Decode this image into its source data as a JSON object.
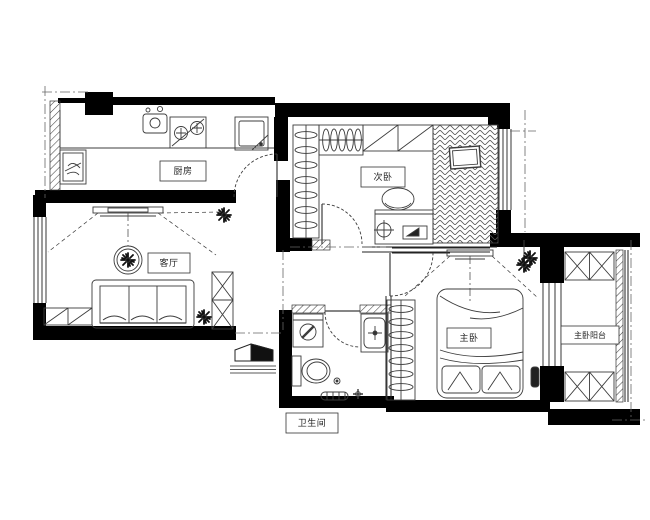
{
  "drawing": {
    "type": "apartment-floor-plan",
    "style": "black-and-white CAD line drawing",
    "colors": {
      "wall": "#000000",
      "line": "#3c3c3c",
      "background": "#ffffff"
    },
    "rooms": {
      "kitchen": {
        "label": "厨房"
      },
      "secondary_bedroom": {
        "label": "次卧"
      },
      "living_room": {
        "label": "客厅"
      },
      "master_bedroom": {
        "label": "主卧"
      },
      "master_balcony": {
        "label": "主卧阳台"
      },
      "bathroom": {
        "label": "卫生间"
      }
    },
    "furniture_icons": [
      "stove-icon",
      "kitchen-sink-icon",
      "fridge-icon",
      "cabinet-icon",
      "wardrobe-hangers-icon",
      "closet-icon",
      "herringbone-bed-icon",
      "pillow-icon",
      "desk-icon",
      "chair-icon",
      "compass-icon",
      "monitor-icon",
      "tv-icon",
      "round-table-icon",
      "sofa-icon",
      "shoe-cabinet-icon",
      "plant-icon",
      "x-storage-cabinet-icon",
      "washing-machine-icon",
      "bathroom-sink-icon",
      "toilet-icon",
      "floor-drain-icon",
      "bath-mat-icon",
      "double-bed-icon",
      "entrance-door-icon",
      "balcony-cabinet-icon"
    ]
  }
}
